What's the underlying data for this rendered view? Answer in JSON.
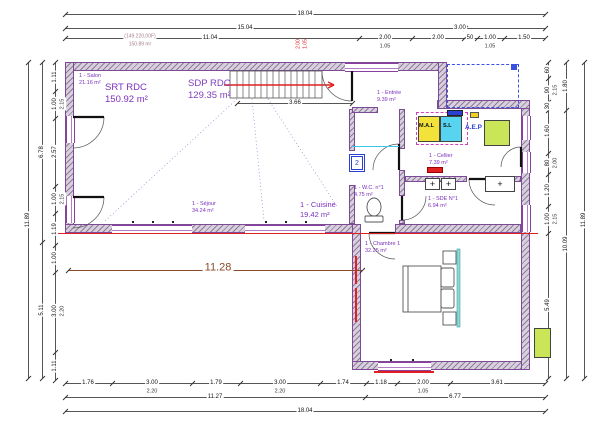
{
  "area_summary": {
    "srt_label": "SRT RDC",
    "srt_value": "150.92 m²",
    "sdp_label": "SDP RDC",
    "sdp_value": "129.35 m²",
    "note_line1": "(149.220,00F)",
    "note_line2": "150.89 m²"
  },
  "rooms": [
    {
      "label": "1 - Salon",
      "area": "21.16 m²"
    },
    {
      "label": "1 - Séjour",
      "area": "34.24 m²"
    },
    {
      "label": "1 - Cuisine",
      "area": "19.42 m²"
    },
    {
      "label": "1 - Entrée",
      "area": "9.39 m²"
    },
    {
      "label": "1 - Cellier",
      "area": "7.39 m²"
    },
    {
      "label": "1 - W.C. n°1",
      "area": "4.75 m²"
    },
    {
      "label": "1 - SDE N°1",
      "area": "6.94 m²"
    },
    {
      "label": "1 - Chambre 1",
      "area": "32.25 m²"
    }
  ],
  "equipment": {
    "washer": "M.A.L",
    "dryer": "S.L",
    "water": "A.E.P",
    "marker": "2",
    "sink_plus": "+"
  },
  "colors": {
    "wall_fill": "#d8d0de",
    "wall_edge": "#7d4b96",
    "room_text": "#7b2fbe",
    "red": "#e02020",
    "cyan": "#57d4f0",
    "yellow": "#f2e23a",
    "green": "#cbe558",
    "blue": "#2a3fd4",
    "brown": "#8a4a2a",
    "dash_blue": "#3a52e0"
  },
  "dim_lines": [
    {
      "o": "h",
      "p": 14,
      "a": 65,
      "b": 545,
      "k": [
        65,
        545
      ]
    },
    {
      "o": "h",
      "p": 28,
      "a": 65,
      "b": 545,
      "k": [
        65,
        465,
        545
      ]
    },
    {
      "o": "h",
      "p": 38,
      "a": 65,
      "b": 545,
      "k": [
        65,
        359,
        412,
        464,
        477,
        504,
        545
      ]
    },
    {
      "o": "h",
      "p": 383,
      "a": 65,
      "b": 545,
      "k": [
        65,
        112,
        192,
        240,
        320,
        366,
        397,
        450,
        545
      ]
    },
    {
      "o": "h",
      "p": 397,
      "a": 65,
      "b": 545,
      "k": [
        65,
        365,
        545
      ]
    },
    {
      "o": "h",
      "p": 411,
      "a": 65,
      "b": 545,
      "k": [
        65,
        545
      ]
    },
    {
      "o": "v",
      "p": 55,
      "a": 62,
      "b": 380,
      "k": [
        62,
        91,
        118,
        186,
        213,
        245,
        272,
        352,
        380
      ]
    },
    {
      "o": "v",
      "p": 42,
      "a": 62,
      "b": 378,
      "k": [
        62,
        242,
        378
      ]
    },
    {
      "o": "v",
      "p": 28,
      "a": 62,
      "b": 378,
      "k": [
        62,
        378
      ]
    },
    {
      "o": "v",
      "p": 548,
      "a": 62,
      "b": 378,
      "k": [
        62,
        78,
        102,
        110,
        153,
        174,
        206,
        233,
        378
      ]
    },
    {
      "o": "v",
      "p": 566,
      "a": 62,
      "b": 378,
      "k": [
        62,
        110,
        378
      ]
    },
    {
      "o": "v",
      "p": 584,
      "a": 62,
      "b": 378,
      "k": [
        62,
        378
      ]
    },
    {
      "o": "h",
      "p": 103,
      "a": 237,
      "b": 352,
      "k": [
        237,
        352
      ]
    },
    {
      "o": "h",
      "p": 270,
      "a": 68,
      "b": 362,
      "k": [
        68,
        362
      ],
      "s": "brown"
    }
  ],
  "dim_labels": [
    {
      "t": "18.04",
      "x": 305,
      "y": 14
    },
    {
      "t": "15.04",
      "x": 245,
      "y": 28
    },
    {
      "t": "3.00",
      "x": 460,
      "y": 28
    },
    {
      "t": "11.04",
      "x": 210,
      "y": 38
    },
    {
      "t": "2.00",
      "x": 385,
      "y": 38
    },
    {
      "t": "1.05",
      "x": 385,
      "y": 47,
      "s": "sec"
    },
    {
      "t": "2.00",
      "x": 438,
      "y": 38
    },
    {
      "t": "50",
      "x": 470,
      "y": 38
    },
    {
      "t": "1.00",
      "x": 490,
      "y": 38
    },
    {
      "t": "1.05",
      "x": 490,
      "y": 47,
      "s": "sec"
    },
    {
      "t": "1.50",
      "x": 524,
      "y": 38
    },
    {
      "t": "(149.220,00F)",
      "x": 140,
      "y": 37,
      "s": "grey"
    },
    {
      "t": "150.89 m²",
      "x": 140,
      "y": 45,
      "s": "grey"
    },
    {
      "t": "2.00",
      "x": 299,
      "y": 44,
      "v": 1,
      "s": "red"
    },
    {
      "t": "1.05",
      "x": 306,
      "y": 44,
      "v": 1,
      "s": "red"
    },
    {
      "t": "1.76",
      "x": 88,
      "y": 383
    },
    {
      "t": "3.00",
      "x": 152,
      "y": 383
    },
    {
      "t": "2.20",
      "x": 152,
      "y": 392,
      "s": "sec"
    },
    {
      "t": "1.79",
      "x": 216,
      "y": 383
    },
    {
      "t": "3.00",
      "x": 280,
      "y": 383
    },
    {
      "t": "2.20",
      "x": 280,
      "y": 392,
      "s": "sec"
    },
    {
      "t": "1.74",
      "x": 343,
      "y": 383
    },
    {
      "t": "1.18",
      "x": 381,
      "y": 383
    },
    {
      "t": "2.00",
      "x": 423,
      "y": 383
    },
    {
      "t": "1.05",
      "x": 423,
      "y": 392,
      "s": "sec"
    },
    {
      "t": "3.61",
      "x": 497,
      "y": 383
    },
    {
      "t": "11.27",
      "x": 215,
      "y": 397
    },
    {
      "t": "6.77",
      "x": 455,
      "y": 397
    },
    {
      "t": "18.04",
      "x": 305,
      "y": 411
    },
    {
      "t": "1.11",
      "x": 55,
      "y": 77,
      "v": 1
    },
    {
      "t": "1.00",
      "x": 55,
      "y": 104,
      "v": 1
    },
    {
      "t": "2.15",
      "x": 63,
      "y": 104,
      "v": 1,
      "s": "sec"
    },
    {
      "t": "2.57",
      "x": 55,
      "y": 152,
      "v": 1
    },
    {
      "t": "1.00",
      "x": 55,
      "y": 199,
      "v": 1
    },
    {
      "t": "2.15",
      "x": 63,
      "y": 199,
      "v": 1,
      "s": "sec"
    },
    {
      "t": "1.19",
      "x": 55,
      "y": 229,
      "v": 1
    },
    {
      "t": "1.00",
      "x": 55,
      "y": 258,
      "v": 1
    },
    {
      "t": "3.00",
      "x": 55,
      "y": 311,
      "v": 1
    },
    {
      "t": "2.20",
      "x": 63,
      "y": 311,
      "v": 1,
      "s": "sec"
    },
    {
      "t": "1.11",
      "x": 55,
      "y": 366,
      "v": 1
    },
    {
      "t": "6.78",
      "x": 42,
      "y": 152,
      "v": 1
    },
    {
      "t": "5.11",
      "x": 42,
      "y": 310,
      "v": 1
    },
    {
      "t": "11.89",
      "x": 28,
      "y": 220,
      "v": 1
    },
    {
      "t": "60",
      "x": 548,
      "y": 70,
      "v": 1
    },
    {
      "t": "90",
      "x": 548,
      "y": 90,
      "v": 1
    },
    {
      "t": "2.15",
      "x": 556,
      "y": 90,
      "v": 1,
      "s": "sec"
    },
    {
      "t": "30",
      "x": 548,
      "y": 106,
      "v": 1
    },
    {
      "t": "1.60",
      "x": 548,
      "y": 131,
      "v": 1
    },
    {
      "t": "80",
      "x": 548,
      "y": 163,
      "v": 1
    },
    {
      "t": "2.00",
      "x": 556,
      "y": 163,
      "v": 1,
      "s": "sec"
    },
    {
      "t": "1.20",
      "x": 548,
      "y": 190,
      "v": 1
    },
    {
      "t": "1.00",
      "x": 548,
      "y": 219,
      "v": 1
    },
    {
      "t": "2.15",
      "x": 556,
      "y": 219,
      "v": 1,
      "s": "sec"
    },
    {
      "t": "5.49",
      "x": 548,
      "y": 305,
      "v": 1
    },
    {
      "t": "1.80",
      "x": 566,
      "y": 86,
      "v": 1
    },
    {
      "t": "10.09",
      "x": 566,
      "y": 244,
      "v": 1
    },
    {
      "t": "11.89",
      "x": 584,
      "y": 220,
      "v": 1
    },
    {
      "t": "11.28",
      "x": 218,
      "y": 268,
      "s": "brown"
    },
    {
      "t": "3.66",
      "x": 295,
      "y": 103
    }
  ]
}
